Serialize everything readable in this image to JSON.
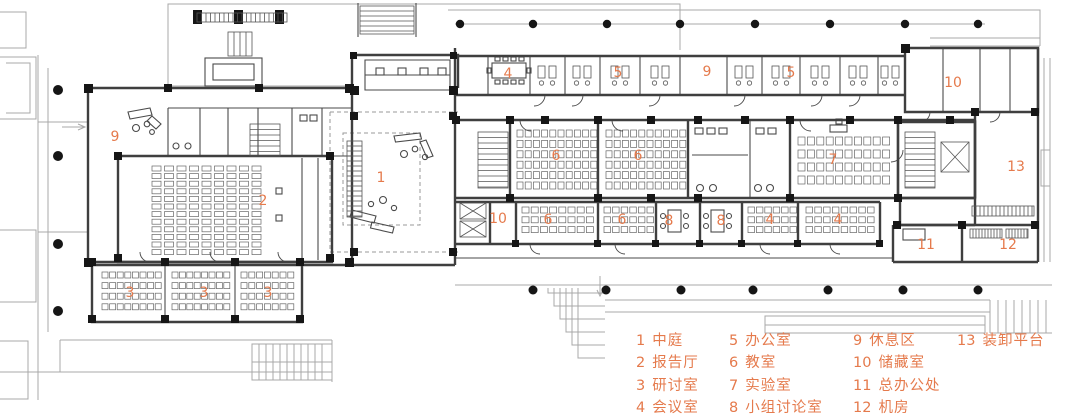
{
  "title": "建筑平面图",
  "colors": {
    "accent": "#e57a4c",
    "wall": "#3f3f3f",
    "partition": "#4a4a4a",
    "light": "#a8a8a8",
    "black": "#161616",
    "background": "#ffffff"
  },
  "plan_labels": [
    {
      "n": "9",
      "x": 115,
      "y": 137
    },
    {
      "n": "2",
      "x": 263,
      "y": 201
    },
    {
      "n": "1",
      "x": 381,
      "y": 178
    },
    {
      "n": "4",
      "x": 508,
      "y": 74
    },
    {
      "n": "5",
      "x": 618,
      "y": 73
    },
    {
      "n": "9",
      "x": 707,
      "y": 72
    },
    {
      "n": "5",
      "x": 791,
      "y": 73
    },
    {
      "n": "10",
      "x": 953,
      "y": 83
    },
    {
      "n": "6",
      "x": 556,
      "y": 156
    },
    {
      "n": "6",
      "x": 638,
      "y": 156
    },
    {
      "n": "7",
      "x": 833,
      "y": 160
    },
    {
      "n": "13",
      "x": 1016,
      "y": 167
    },
    {
      "n": "10",
      "x": 498,
      "y": 219
    },
    {
      "n": "6",
      "x": 548,
      "y": 220
    },
    {
      "n": "6",
      "x": 622,
      "y": 220
    },
    {
      "n": "8",
      "x": 669,
      "y": 221
    },
    {
      "n": "8",
      "x": 721,
      "y": 221
    },
    {
      "n": "4",
      "x": 770,
      "y": 220
    },
    {
      "n": "4",
      "x": 838,
      "y": 220
    },
    {
      "n": "11",
      "x": 926,
      "y": 245
    },
    {
      "n": "12",
      "x": 1008,
      "y": 245
    },
    {
      "n": "3",
      "x": 130,
      "y": 293
    },
    {
      "n": "3",
      "x": 204,
      "y": 293
    },
    {
      "n": "3",
      "x": 268,
      "y": 293
    }
  ],
  "legend": {
    "columns": [
      {
        "x": 636,
        "y": 329,
        "items": [
          {
            "num": "1",
            "label": "中庭"
          },
          {
            "num": "2",
            "label": "报告厅"
          },
          {
            "num": "3",
            "label": "研讨室"
          },
          {
            "num": "4",
            "label": "会议室"
          }
        ]
      },
      {
        "x": 729,
        "y": 329,
        "items": [
          {
            "num": "5",
            "label": "办公室"
          },
          {
            "num": "6",
            "label": "教室"
          },
          {
            "num": "7",
            "label": "实验室"
          },
          {
            "num": "8",
            "label": "小组讨论室"
          }
        ]
      },
      {
        "x": 853,
        "y": 329,
        "items": [
          {
            "num": "9",
            "label": "休息区"
          },
          {
            "num": "10",
            "label": "储藏室"
          },
          {
            "num": "11",
            "label": "总办公处"
          },
          {
            "num": "12",
            "label": "机房"
          }
        ]
      },
      {
        "x": 957,
        "y": 329,
        "items": [
          {
            "num": "13",
            "label": "装卸平台"
          }
        ]
      }
    ]
  }
}
